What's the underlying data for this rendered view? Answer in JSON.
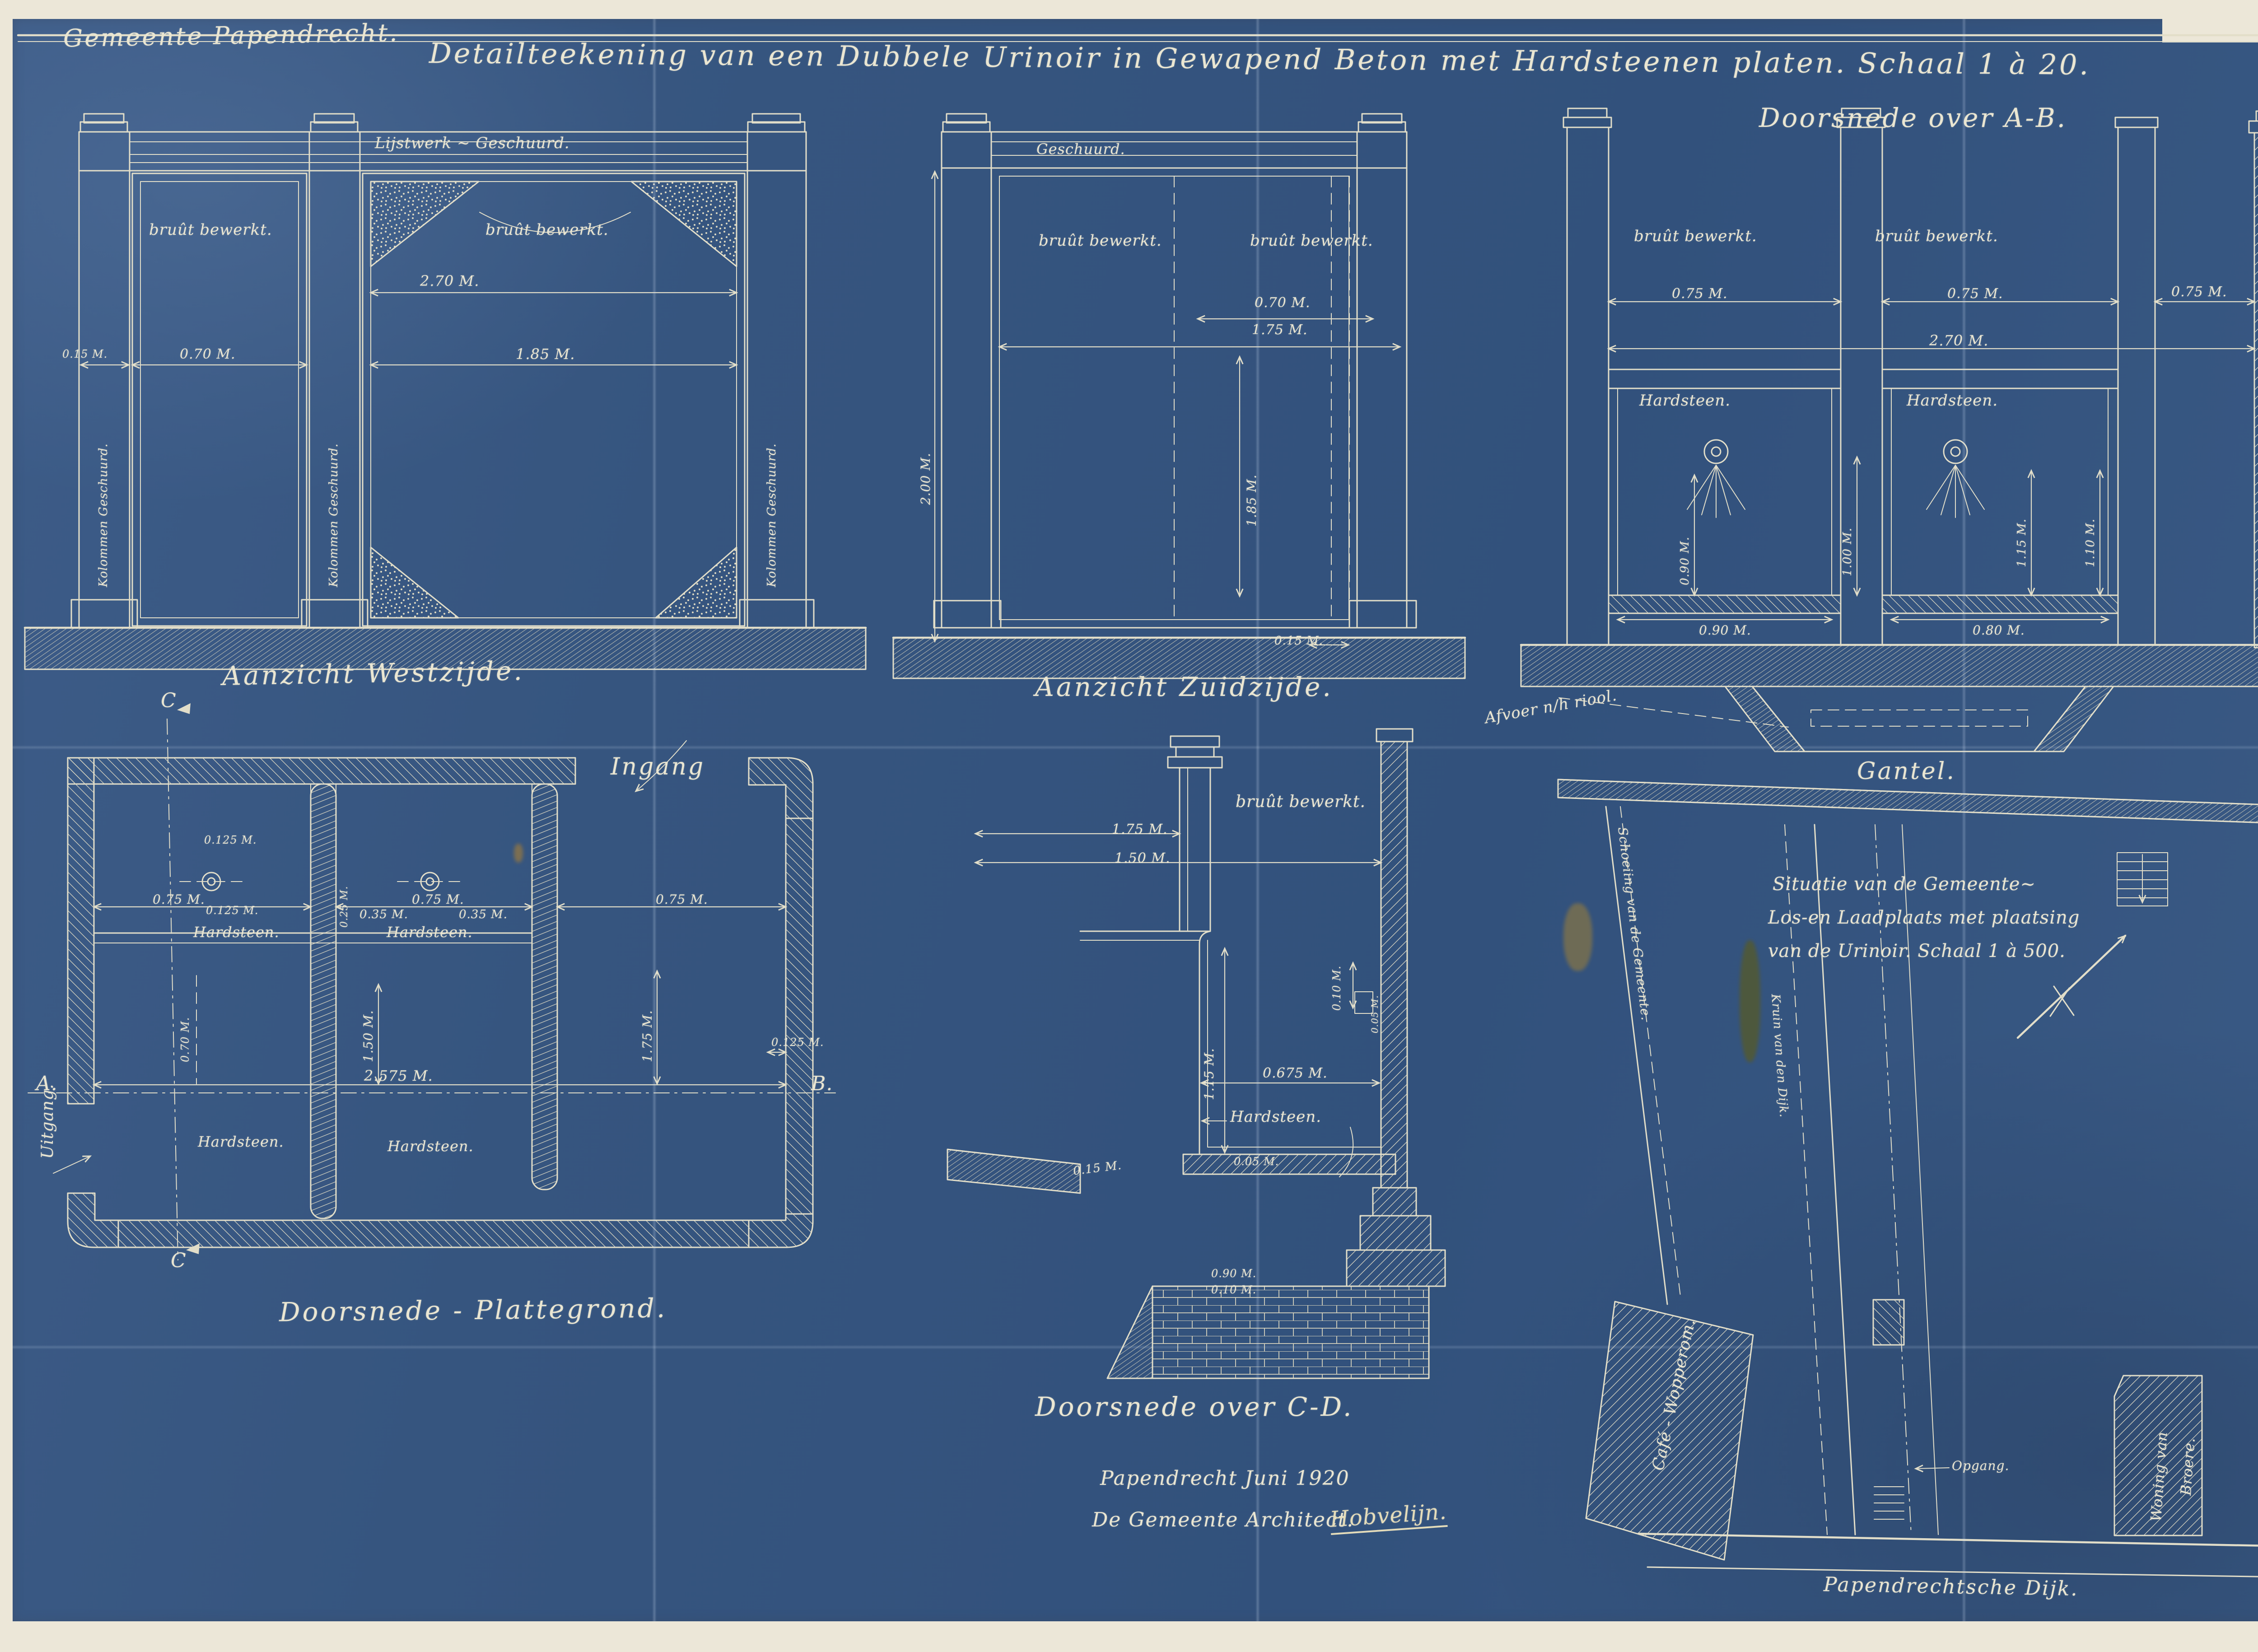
{
  "colors": {
    "paper": "#ece7d8",
    "sheet_blue": "#36557f",
    "line_cream": "#e2dec9",
    "text_cream": "#eae6d2",
    "stain_olive": "#565a28",
    "stain_gold": "#a9842f"
  },
  "header": {
    "municipality": "Gemeente Papendrecht.",
    "title": "Detailteekening van een Dubbele Urinoir in Gewapend Beton met Hardsteenen platen. Schaal 1 à 20.",
    "section_ab_caption": "Doorsnede over A-B."
  },
  "west_elevation": {
    "caption": "Aanzicht Westzijde.",
    "lijstwerk": "Lijstwerk ~ Geschuurd.",
    "bruut": "bruût bewerkt.",
    "kolommen": "Kolommen Geschuurd.",
    "d270": "2.70 M.",
    "d015": "0.15 M.",
    "d070": "0.70 M.",
    "d185": "1.85 M."
  },
  "zuid_elevation": {
    "caption": "Aanzicht Zuidzijde.",
    "geschuurd": "Geschuurd.",
    "bruut": "bruût bewerkt.",
    "d070": "0.70 M.",
    "d175": "1.75 M.",
    "d200": "2.00 M.",
    "d185": "1.85 M.",
    "d015": "0.15 M."
  },
  "section_ab": {
    "bruut": "bruût bewerkt.",
    "hardsteen": "Hardsteen.",
    "d075": "0.75 M.",
    "d270": "2.70 M.",
    "d090v": "0.90 M.",
    "d100v": "1.00 M.",
    "d115v": "1.15 M.",
    "d110v": "1.10 M.",
    "d090": "0.90 M.",
    "d080": "0.80 M.",
    "afvoer": "Afvoer n/h riool.",
    "gantel": "Gantel."
  },
  "plan": {
    "caption": "Doorsnede - Plattegrond.",
    "ingang": "Ingang",
    "uitgang": "Uitgang.",
    "a": "A.",
    "b": "B.",
    "c_top": "C",
    "c_bottom": "C",
    "hardsteen": "Hardsteen.",
    "d0125": "0.125 M.",
    "d035": "0.35 M.",
    "d025": "0.25 M.",
    "d075": "0.75 M.",
    "d070": "0.70 M.",
    "d150": "1.50 M.",
    "d175": "1.75 M.",
    "d2575": "2.575 M."
  },
  "section_cd": {
    "caption": "Doorsnede over C-D.",
    "bruut": "bruût bewerkt.",
    "hardsteen": "Hardsteen.",
    "d175": "1.75 M.",
    "d150": "1.50 M.",
    "d115": "1.15 M.",
    "d010": "0.10 M.",
    "d0675": "0.675 M.",
    "d005": "0.05 M.",
    "d015": "0.15 M.",
    "d090": "0.90 M."
  },
  "signature": {
    "place_date": "Papendrecht      Juni 1920",
    "role": "De Gemeente Architect.",
    "name": "Hobvelijn."
  },
  "situatie": {
    "text_line1": "Situatie van de Gemeente~",
    "text_line2": "Los-en Laadplaats met plaatsing",
    "text_line3": "van de Urinoir.   Schaal 1 à 500.",
    "schoeiing": "Schoeiing van de Gemeente.",
    "kruin": "Kruin van den Dijk.",
    "cafe": "Café - Wopperom.",
    "woning_line1": "Woning van",
    "woning_line2": "Broere.",
    "dijk": "Papendrechtsche Dijk.",
    "opgang": "Opgang."
  }
}
